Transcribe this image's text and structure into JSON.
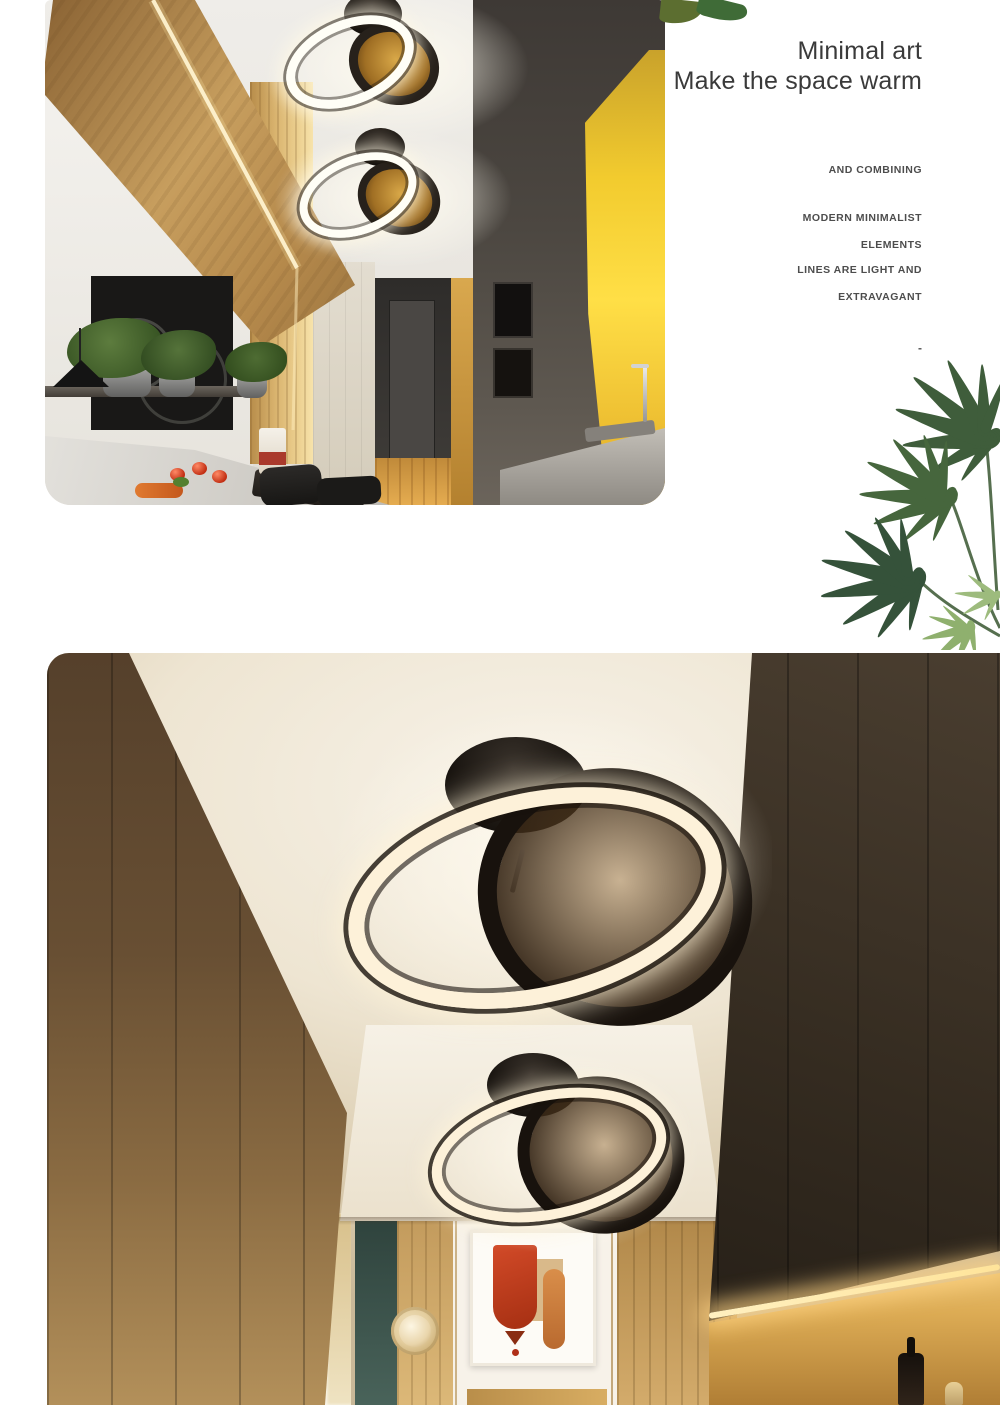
{
  "headline": {
    "line1": "Minimal art",
    "line2": "Make the space warm"
  },
  "tagline": {
    "line1": "AND COMBINING",
    "line2": "MODERN MINIMALIST",
    "line3": "ELEMENTS",
    "line4": "LINES ARE LIGHT AND",
    "line5": "EXTRAVAGANT",
    "dash": "-"
  },
  "palette": {
    "headline_text": "#3a3a3a",
    "tagline_text": "#4d4d4d",
    "leaf_dark_green": "#3f5d3b",
    "leaf_light_green": "#8fb06e",
    "wood_warm": "#b98d52",
    "glow_yellow": "#f2cb2e",
    "led_warm_white": "#fdf1d9",
    "artwork_red": "#c03a20",
    "teal_accent": "#3d574e"
  }
}
